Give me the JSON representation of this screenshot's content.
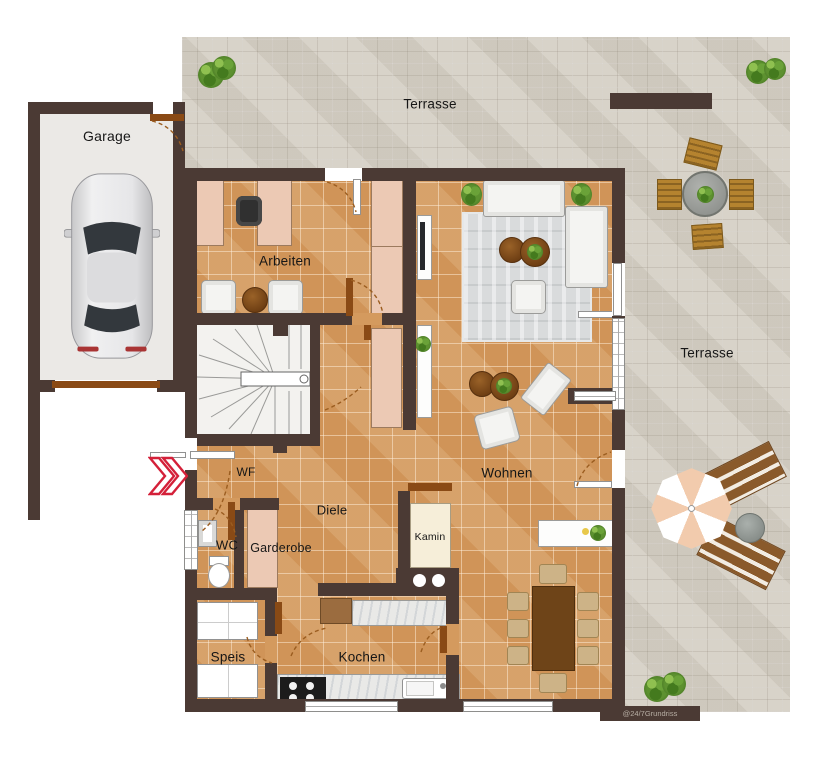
{
  "watermark": "@24/7Grundriss",
  "rooms": {
    "garage": "Garage",
    "terrasse_top": "Terrasse",
    "terrasse_right": "Terrasse",
    "arbeiten": "Arbeiten",
    "wohnen": "Wohnen",
    "diele": "Diele",
    "wf": "WF",
    "wc": "WC",
    "garderobe": "Garderobe",
    "speis": "Speis",
    "kochen": "Kochen",
    "kamin": "Kamin"
  },
  "colors": {
    "wall": "#4b3a34",
    "tile_floor": "#d49a5e",
    "terrace_paver": "#d6d1c6",
    "garage_floor": "#ebe9e6",
    "wood_door": "#8a4a15",
    "accent_red": "#d42039"
  },
  "icons": [
    "car",
    "staircase",
    "office-desk",
    "office-chair",
    "armchair",
    "round-side-table",
    "wardrobe",
    "sideboard",
    "tv-lowboard",
    "sofa",
    "corner-sofa",
    "rug",
    "coffee-table",
    "chaise-longue",
    "dining-table",
    "dining-chair",
    "kitchen-counter",
    "stove",
    "kitchen-sink",
    "pantry-shelf",
    "toilet",
    "wash-basin",
    "coat-closet",
    "fireplace",
    "log-niche",
    "outdoor-dining-table",
    "outdoor-chair",
    "parasol",
    "sun-lounger",
    "outdoor-side-table",
    "potted-plant",
    "privacy-wall",
    "entrance-chevrons",
    "door-leaf",
    "window"
  ]
}
